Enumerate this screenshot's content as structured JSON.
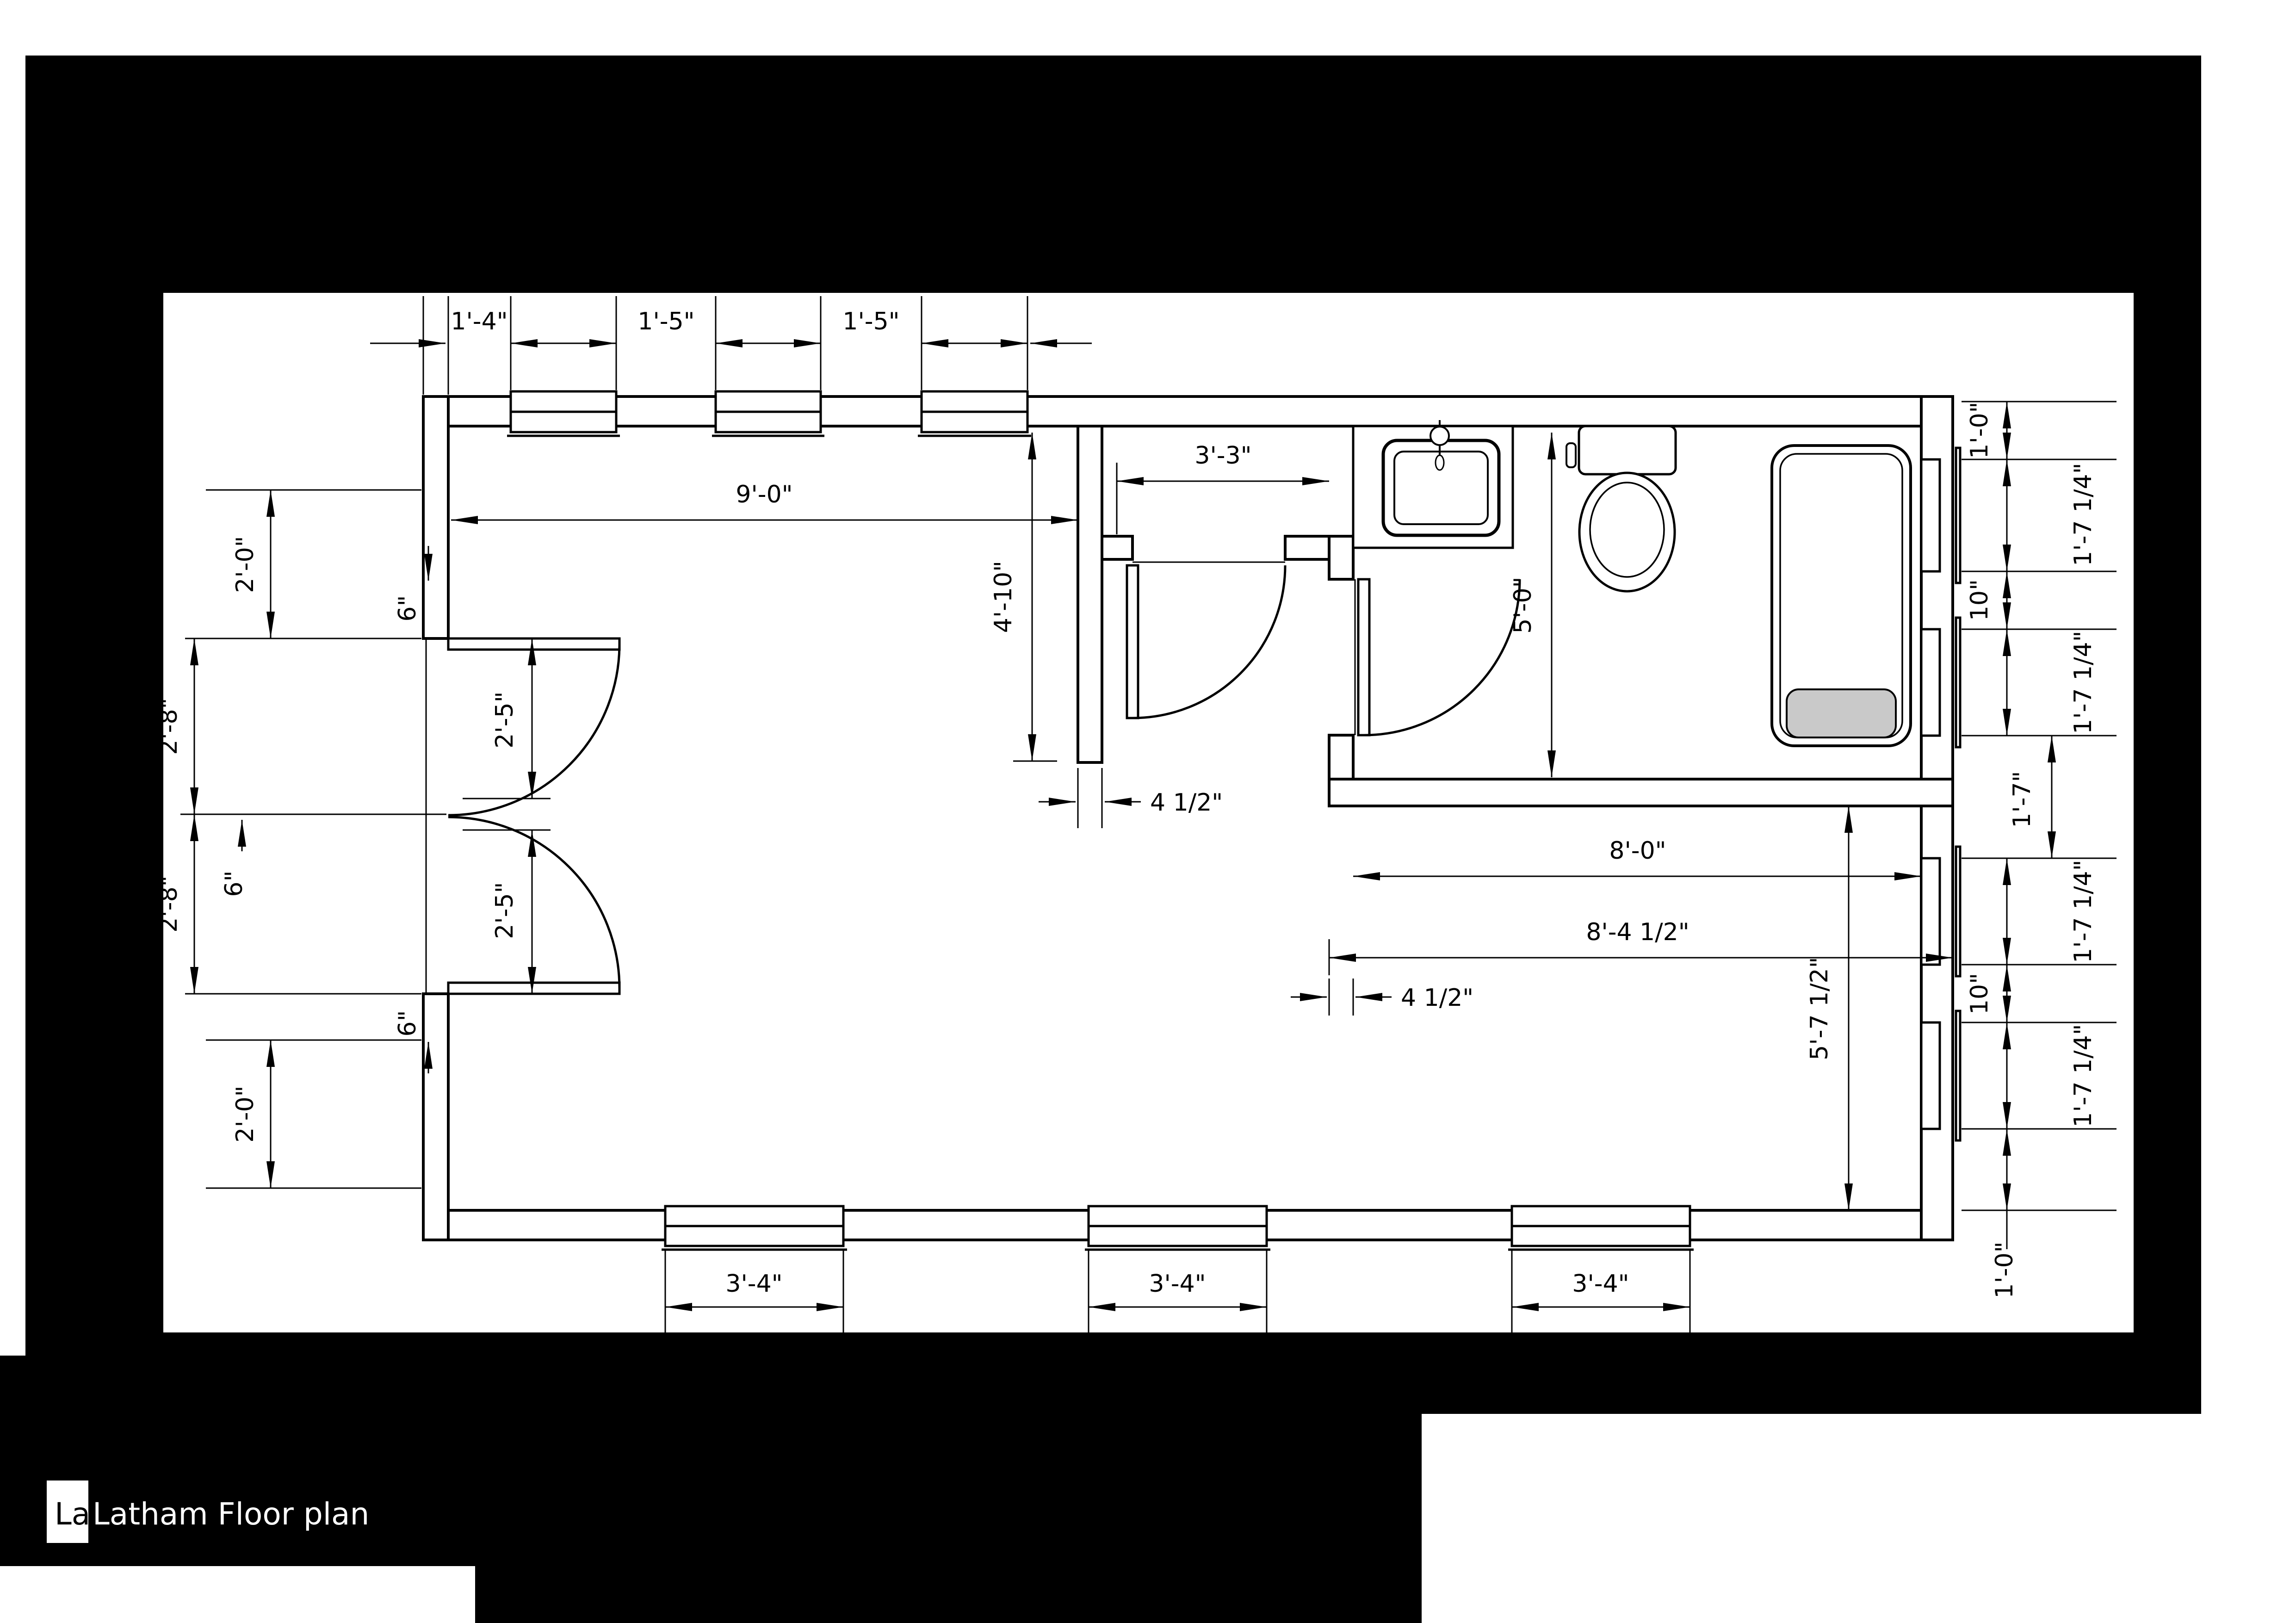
{
  "window_title": {
    "tab_label": "Lat",
    "title": "Latham Floor plan"
  },
  "floor_plan": {
    "dims_top": [
      "1'-4\"",
      "1'-5\"",
      "1'-5\""
    ],
    "dims_bottom": [
      "3'-4\"",
      "3'-4\"",
      "3'-4\""
    ],
    "dims_left_outer": [
      "2'-0\"",
      "2'-8\"",
      "2'-8\"",
      "2'-0\""
    ],
    "dims_left_door_leaves": [
      "2'-5\"",
      "2'-5\""
    ],
    "dims_left_small": [
      "6\"",
      "6\"",
      "6\""
    ],
    "dims_right": [
      "1'-0\"",
      "1'-7 1/4\"",
      "10\"",
      "1'-7 1/4\"",
      "1'-7 1/4\"",
      "10\"",
      "1'-7 1/4\"",
      "1'-0\""
    ],
    "dim_right_center": "1'-7\"",
    "dim_room_width": "9'-0\"",
    "dim_wall_length": "4'-10\"",
    "dim_closet_width": "3'-3\"",
    "dim_bath_depth": "5'-0\"",
    "dim_wall_thickness_a": "4 1/2\"",
    "dim_bath_width_inner": "8'-0\"",
    "dim_bath_width_outer": "8'-4 1/2\"",
    "dim_wall_thickness_b": "4 1/2\"",
    "dim_lower_room_depth": "5'-7 1/2\""
  },
  "colors": {
    "background": "#000000",
    "paper": "#ffffff",
    "line": "#000000",
    "tub_fill": "#c9c9c9"
  }
}
